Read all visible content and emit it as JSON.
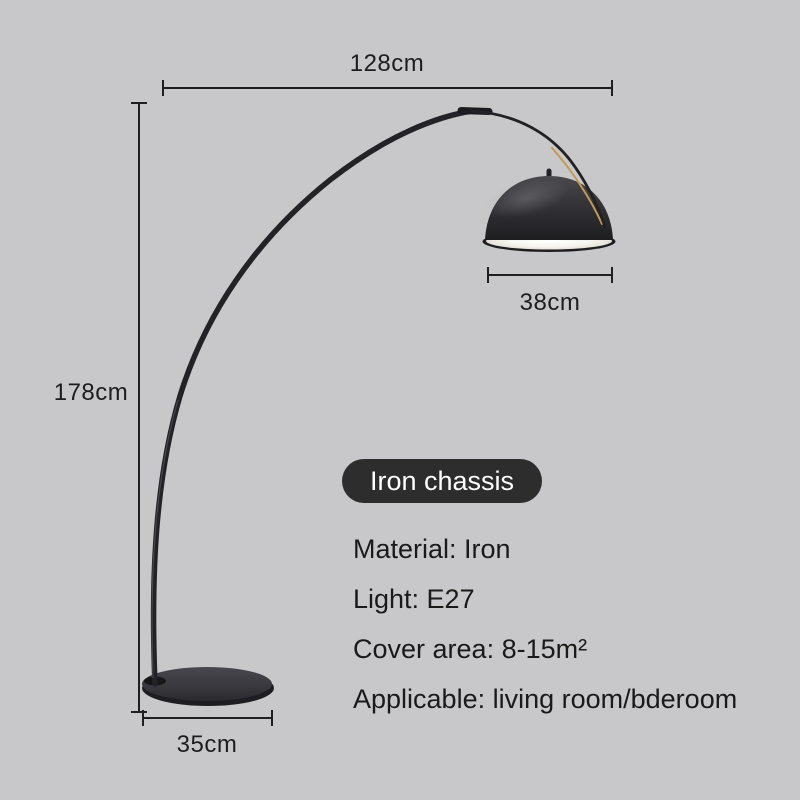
{
  "page": {
    "type": "product-dimension-diagram",
    "background_color": "#c8c8ca"
  },
  "product": {
    "name": "arc-floor-lamp",
    "body_color": "#27272b",
    "shade_inner_color": "#f5f3ec",
    "gold_accent_color": "#c49a52"
  },
  "dimensions": {
    "top": "128cm",
    "left": "178cm",
    "shade": "38cm",
    "base": "35cm"
  },
  "badge": {
    "label": "Iron chassis",
    "bg_color": "#2d2d2d",
    "text_color": "#ffffff"
  },
  "specs": {
    "lines": [
      "Material: Iron",
      "Light: E27",
      "Cover area: 8-15m²",
      "Applicable: living room/bderoom"
    ]
  }
}
